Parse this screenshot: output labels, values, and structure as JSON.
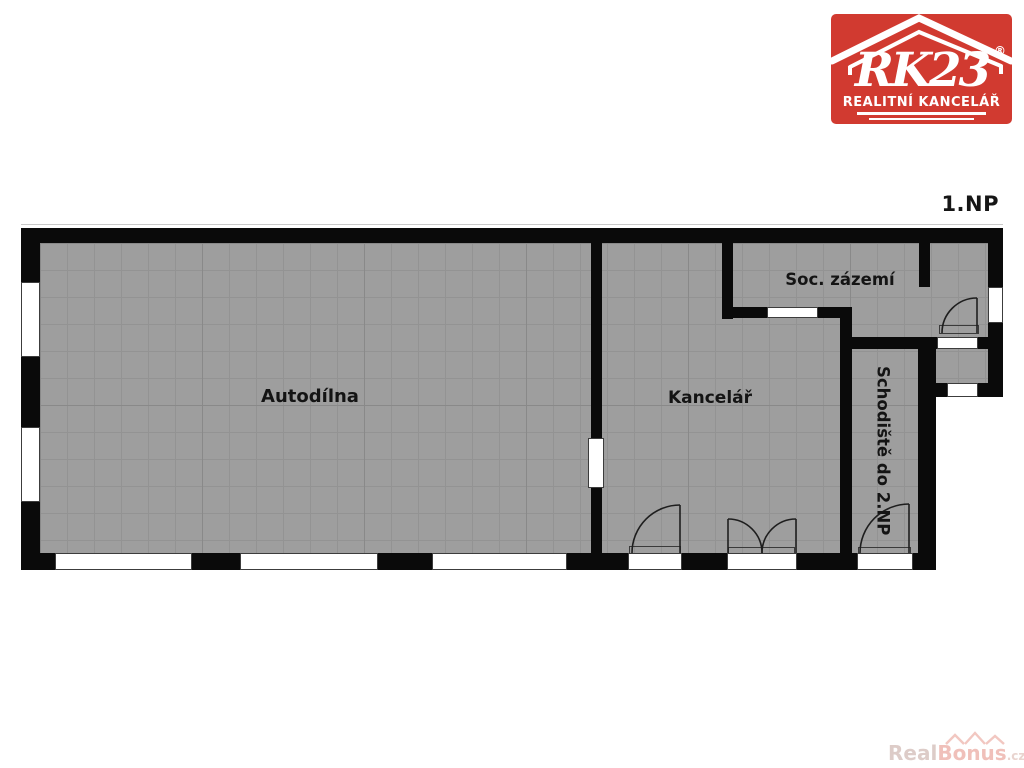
{
  "title": "1.NP",
  "logo": {
    "brand": "RK23",
    "registered": "®",
    "subtitle": "REALITNÍ KANCELÁŘ",
    "bg_color": "#d13a30"
  },
  "rooms": {
    "autodilna": {
      "label": "Autodílna"
    },
    "kancelar": {
      "label": "Kancelář"
    },
    "soc_zazemi": {
      "label": "Soc. zázemí"
    },
    "schodiste": {
      "label": "Schodiště do 2.NP"
    }
  },
  "watermark": {
    "part1": "Real",
    "part2": "Bonus",
    "suffix": ".cz"
  },
  "colors": {
    "wall": "#0a0a0a",
    "floor": "#9e9e9e",
    "logo_red": "#d13a30",
    "watermark_pink": "#f0c0ba"
  }
}
